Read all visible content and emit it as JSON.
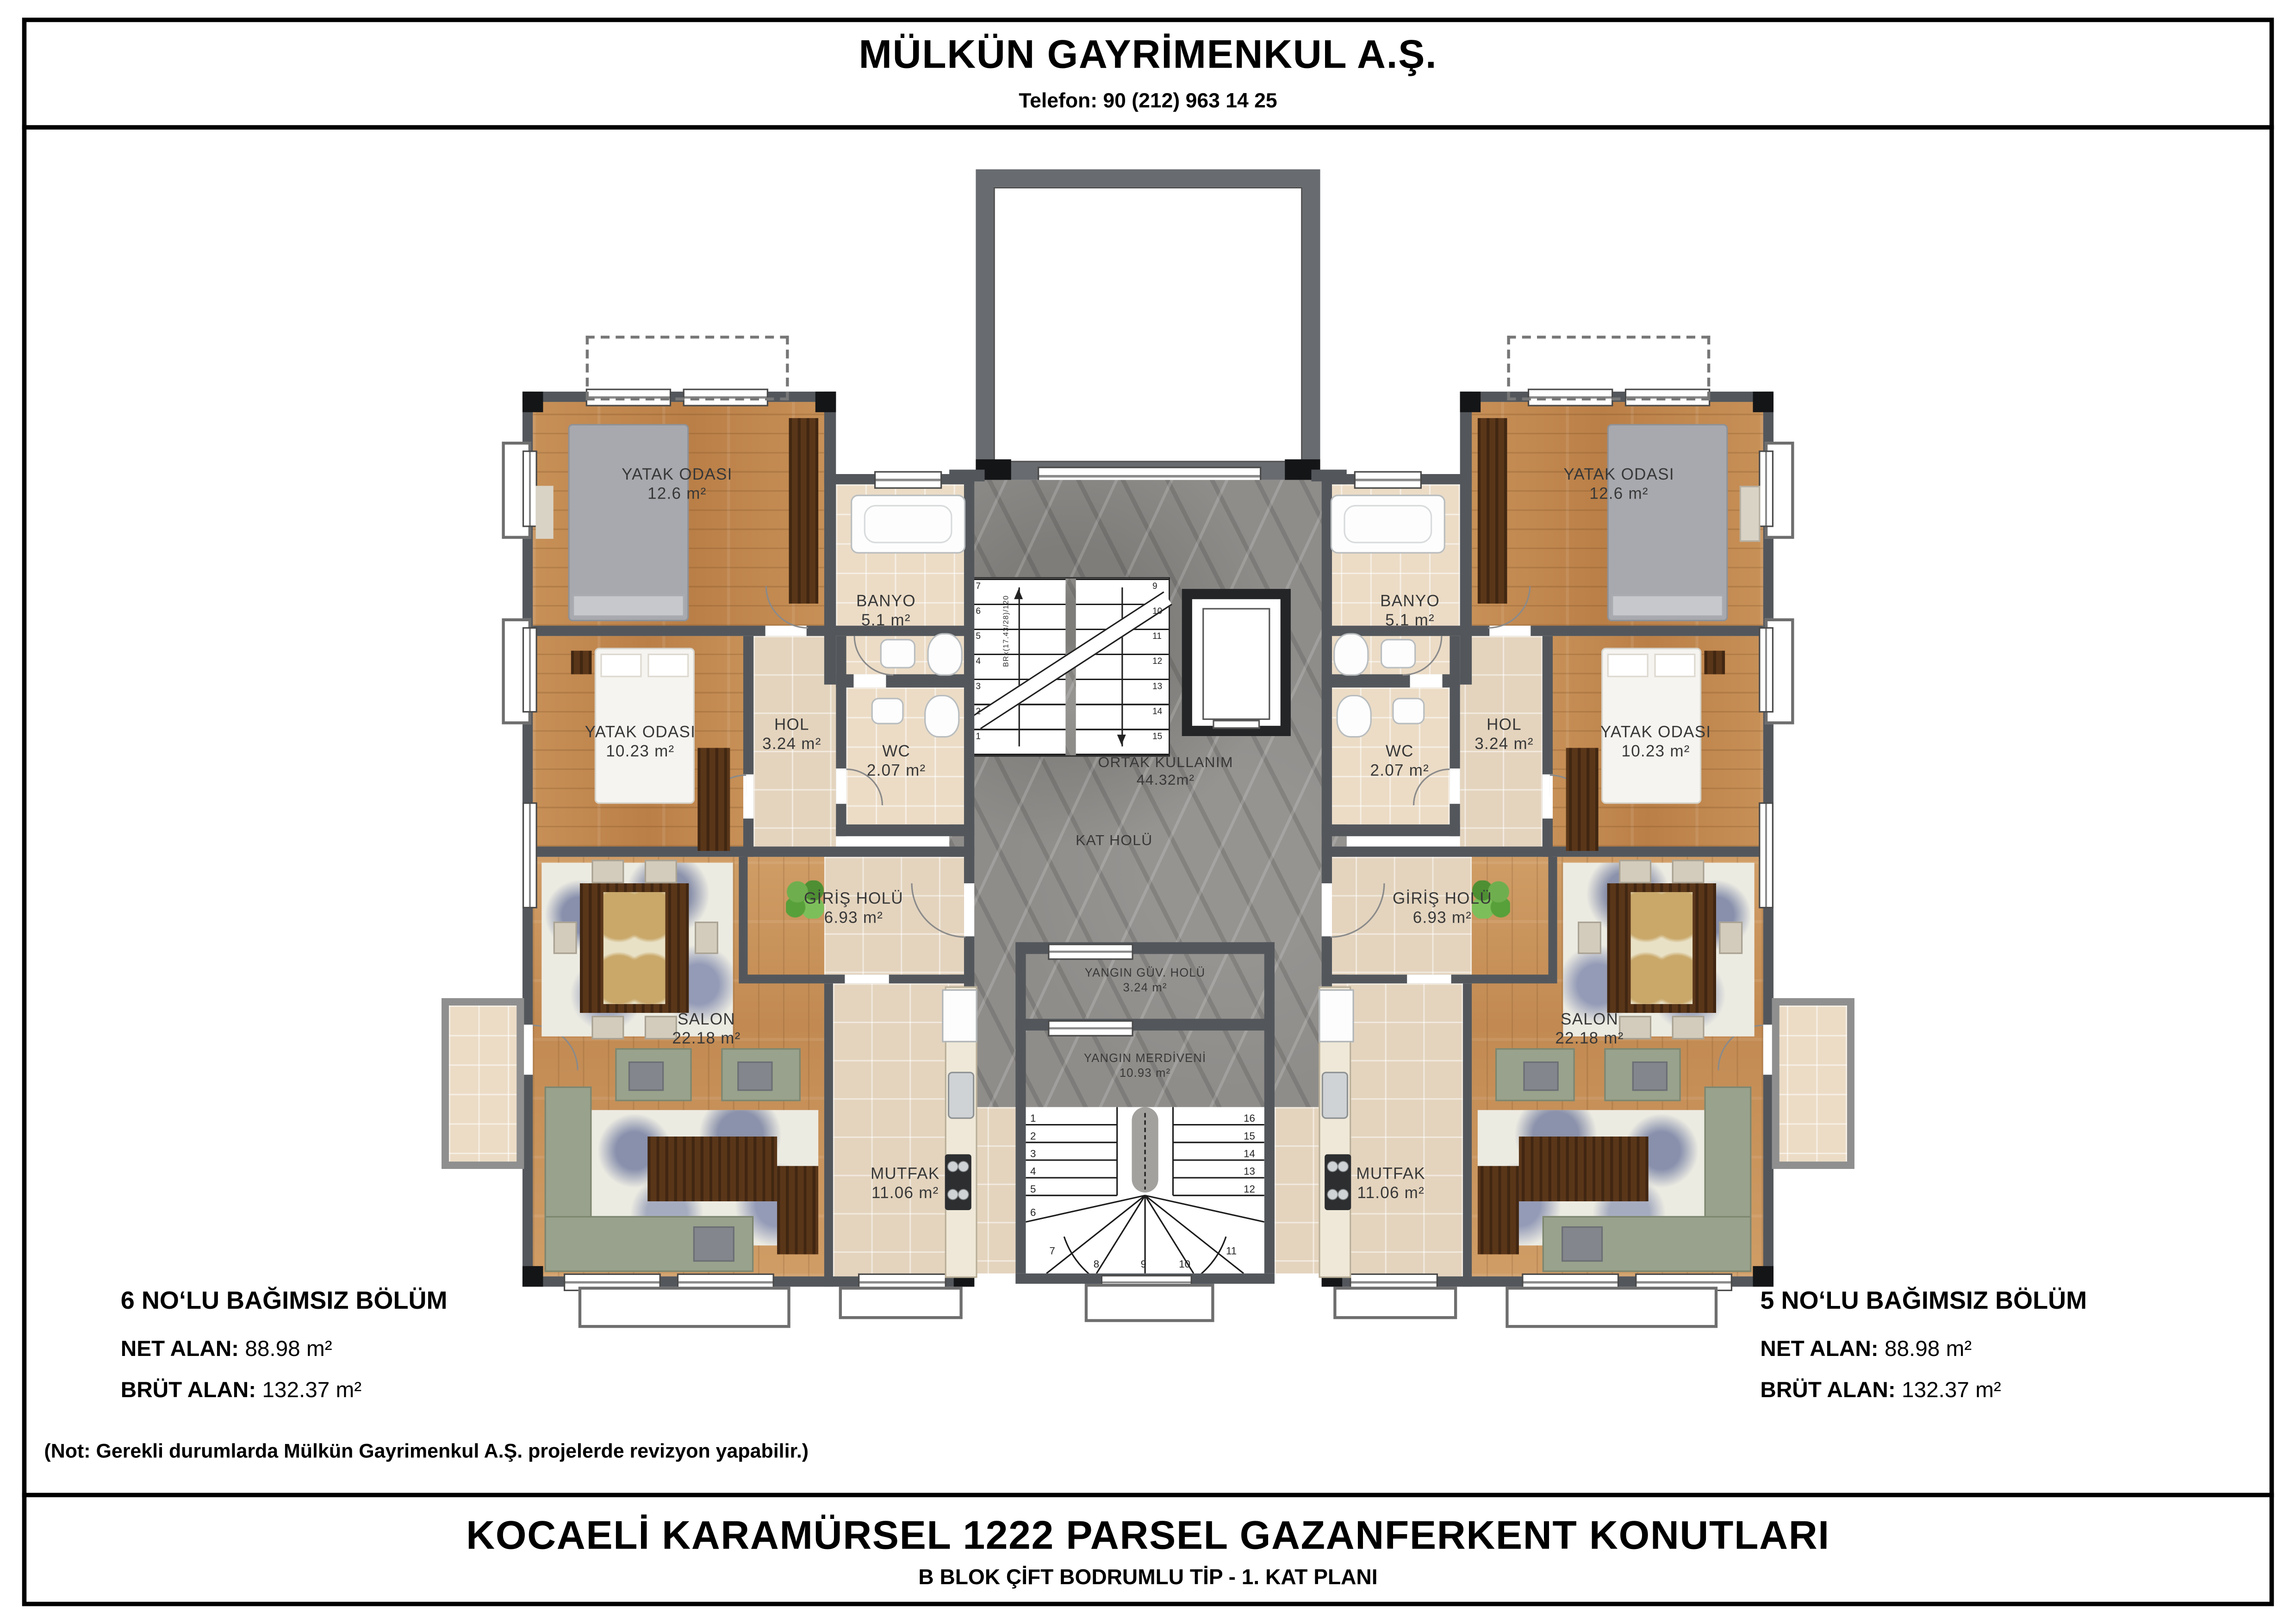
{
  "header": {
    "company": "MÜLKÜN GAYRİMENKUL A.Ş.",
    "phone": "Telefon: 90 (212) 963 14 25"
  },
  "footer": {
    "title": "KOCAELİ KARAMÜRSEL 1222 PARSEL GAZANFERKENT KONUTLARI",
    "subtitle": "B BLOK ÇİFT BODRUMLU TİP - 1. KAT PLANI"
  },
  "note": "(Not: Gerekli durumlarda Mülkün Gayrimenkul A.Ş. projelerde revizyon yapabilir.)",
  "units": {
    "left": {
      "title": "6 NO‘LU BAĞIMSIZ BÖLÜM",
      "net_label": "NET ALAN:",
      "net_value": "88.98 m²",
      "brut_label": "BRÜT ALAN:",
      "brut_value": "132.37 m²"
    },
    "right": {
      "title": "5 NO‘LU BAĞIMSIZ BÖLÜM",
      "net_label": "NET ALAN:",
      "net_value": "88.98 m²",
      "brut_label": "BRÜT ALAN:",
      "brut_value": "132.37 m²"
    }
  },
  "rooms": {
    "yatak1": {
      "name": "YATAK ODASI",
      "area": "12.6 m²"
    },
    "banyo": {
      "name": "BANYO",
      "area": "5.1 m²"
    },
    "yatak2": {
      "name": "YATAK ODASI",
      "area": "10.23 m²"
    },
    "hol": {
      "name": "HOL",
      "area": "3.24 m²"
    },
    "wc": {
      "name": "WC",
      "area": "2.07 m²"
    },
    "giris": {
      "name": "GİRİŞ HOLÜ",
      "area": "6.93 m²"
    },
    "salon": {
      "name": "SALON",
      "area": "22.18 m²"
    },
    "mutfak": {
      "name": "MUTFAK",
      "area": "11.06 m²"
    }
  },
  "common": {
    "ortak": {
      "name": "ORTAK KULLANIM",
      "area": "44.32m²"
    },
    "kat_holu": {
      "name": "KAT HOLÜ"
    },
    "yangin_guv": {
      "name": "YANGIN GÜV. HOLÜ",
      "area": "3.24 m²"
    },
    "yangin_merd": {
      "name": "YANGIN MERDİVENİ",
      "area": "10.93 m²"
    },
    "stair_annotation": "BRx(17.43/28)/120"
  },
  "stairs": {
    "main_left_numbers": [
      "7",
      "6",
      "5",
      "4",
      "3",
      "2",
      "1"
    ],
    "main_right_numbers": [
      "9",
      "10",
      "11",
      "12",
      "13",
      "14",
      "15"
    ],
    "fire_left_numbers": [
      "1",
      "2",
      "3",
      "4",
      "5",
      "6"
    ],
    "fire_right_numbers": [
      "16",
      "15",
      "14",
      "13",
      "12",
      "11"
    ],
    "fire_fan_numbers": [
      "7",
      "8",
      "9",
      "10"
    ]
  },
  "colors": {
    "wall_gray": "#53575c",
    "wall_black": "#141517",
    "wood_floor": "#c38c55",
    "tile_floor": "#e4d4be",
    "marble_floor": "#8f8d8a",
    "sofa_sage": "#99a28c"
  }
}
